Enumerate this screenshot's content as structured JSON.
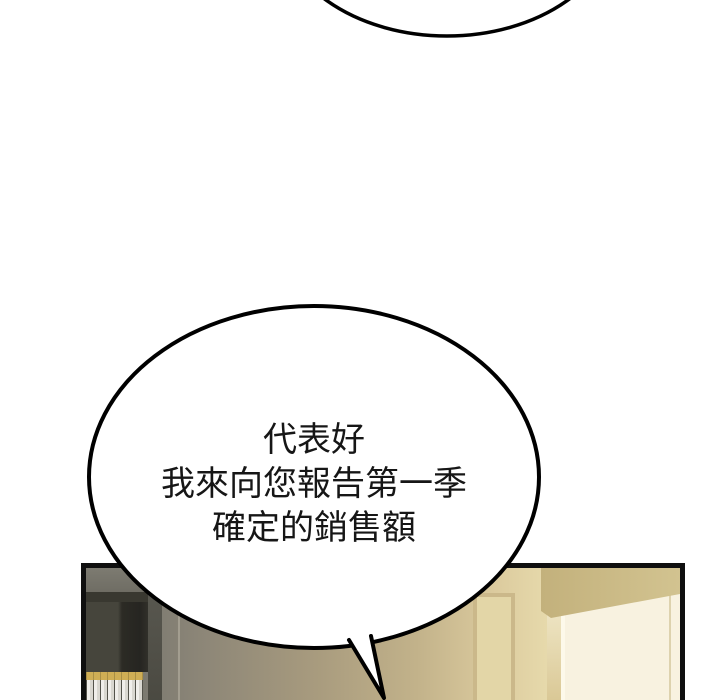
{
  "dialogue": {
    "bubble_lines": [
      "代表好",
      "我來向您報告第一季",
      "確定的銷售額"
    ]
  },
  "colors": {
    "page_background": "#ffffff",
    "bubble_fill": "#ffffff",
    "bubble_stroke": "#000000",
    "dialogue_text": "#161616",
    "panel_border": "#0f0f0f",
    "wall_gray": "#8b8577",
    "wall_tan": "#c2b28a",
    "wall_beige": "#e6d9ab",
    "wall_cream": "#f8f2e0",
    "ceiling_tan": "#c9b883",
    "door_frame": "#cbb88a",
    "books_white": "#f0eeea",
    "books_gold_top": "#cfae55",
    "shelf_dark": "#2c2b25"
  }
}
